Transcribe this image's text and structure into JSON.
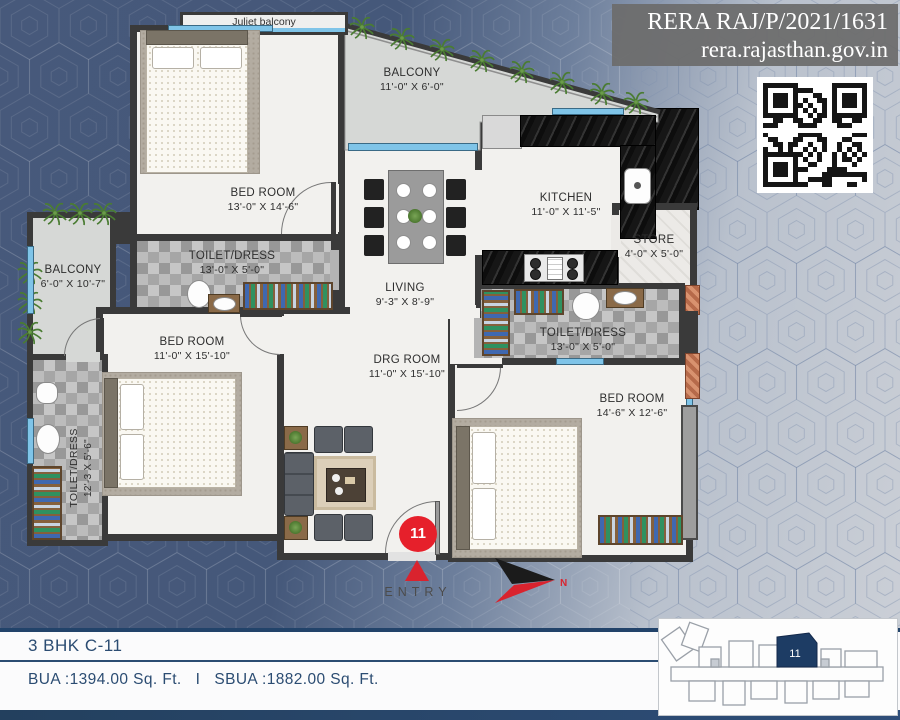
{
  "header": {
    "rera_line1": "RERA RAJ/P/2021/1631",
    "rera_line2": "rera.rajasthan.gov.in"
  },
  "rooms": {
    "juliet": {
      "name": "Juliet balcony"
    },
    "balcony_top": {
      "name": "BALCONY",
      "dim": "11'-0\" X 6'-0\""
    },
    "bedroom1": {
      "name": "BED ROOM",
      "dim": "13'-0\" X 14'-6\""
    },
    "toilet_top": {
      "name": "TOILET/DRESS",
      "dim": "13'-0\" X 5'-0\""
    },
    "kitchen": {
      "name": "KITCHEN",
      "dim": "11'-0\" X 11'-5\""
    },
    "store": {
      "name": "STORE",
      "dim": "4'-0\" X 5'-0\""
    },
    "balcony_left": {
      "name": "BALCONY",
      "dim": "6'-0\" X 10'-7\""
    },
    "living": {
      "name": "LIVING",
      "dim": "9'-3\" X 8'-9\""
    },
    "bedroom2": {
      "name": "BED ROOM",
      "dim": "11'-0\" X 15'-10\""
    },
    "toilet_right": {
      "name": "TOILET/DRESS",
      "dim": "13'-0\" X 5'-0\""
    },
    "drg": {
      "name": "DRG ROOM",
      "dim": "11'-0\" X 15'-10\""
    },
    "bedroom3": {
      "name": "BED ROOM",
      "dim": "14'-6\" X 12'-6\""
    },
    "toilet_left": {
      "name": "TOILET/DRESS",
      "dim": "12'-3 X 5'-6\""
    }
  },
  "plan": {
    "entry_label": "ENTRY",
    "unit_marker": "11",
    "compass_label": "N"
  },
  "footer": {
    "unit_title": "3 BHK C-11",
    "bua": "BUA :1394.00 Sq. Ft.",
    "separator": "I",
    "sbua": "SBUA :1882.00 Sq. Ft."
  },
  "keyplan": {
    "unit_number": "11"
  },
  "colors": {
    "accent_red": "#e6202b",
    "navy_text": "#2b4c72",
    "wall": "#3a3a3a",
    "window_blue": "#7fc4e8",
    "keyplan_navy": "#1d3c64",
    "balcony_floor": "#d6d8d6"
  }
}
